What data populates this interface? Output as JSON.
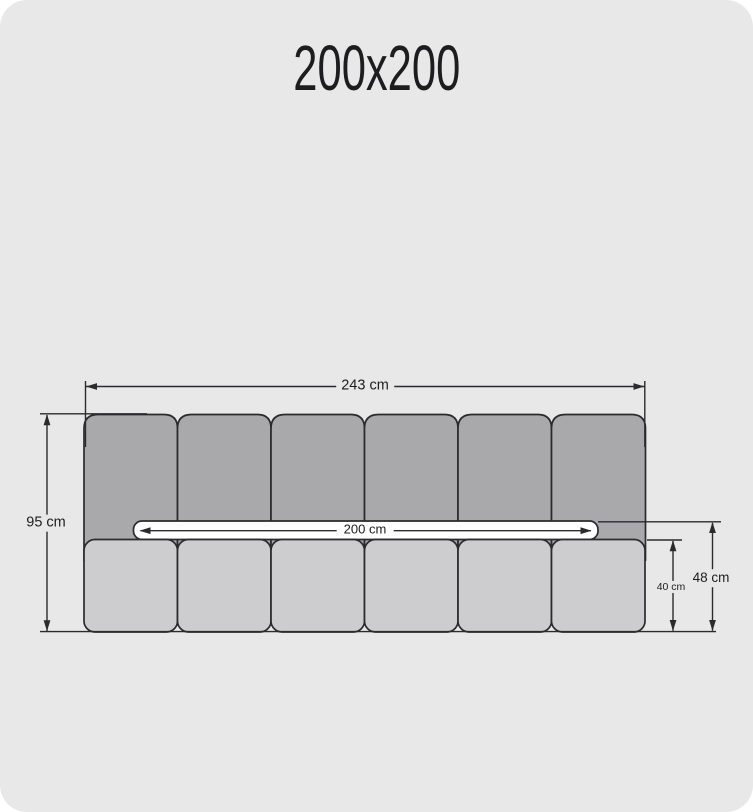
{
  "title": "200x200",
  "colors": {
    "page_bg": "#ffffff",
    "panel_bg": "#e8e8e8",
    "back_cushion": "#a9a9ab",
    "seat_cushion": "#cdcdcf",
    "mattress": "#ffffff",
    "line": "#2b2b2e",
    "text": "#1d1d1f"
  },
  "diagram": {
    "type": "furniture-dimension-drawing",
    "back_cushion_count": 6,
    "seat_cushion_count": 6,
    "dimensions": {
      "overall_width": "243 cm",
      "overall_height": "95 cm",
      "inner_width": "200 cm",
      "seat_height": "40 cm",
      "backrest_gap_height": "48 cm"
    }
  }
}
